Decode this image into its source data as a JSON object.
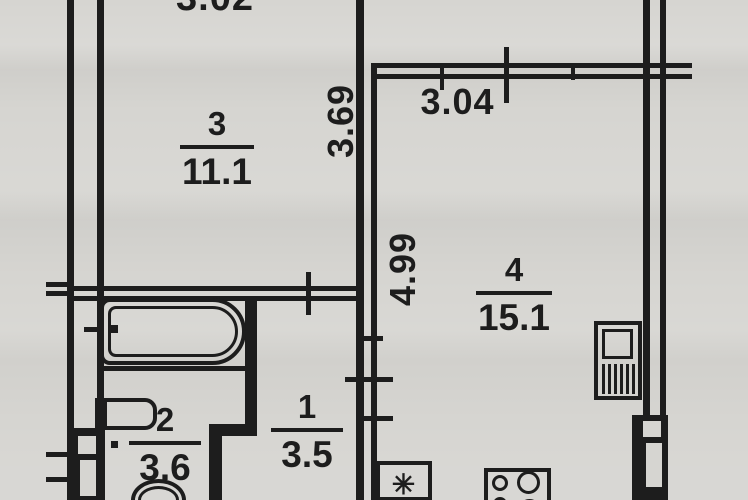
{
  "rooms": [
    {
      "number": "3",
      "area": "11.1"
    },
    {
      "number": "4",
      "area": "15.1"
    },
    {
      "number": "2",
      "area": "3.6"
    },
    {
      "number": "1",
      "area": "3.5"
    }
  ],
  "dimensions": {
    "top_width_partial": "3.02",
    "room3_depth": "3.69",
    "kitchen_width": "3.04",
    "kitchen_depth": "4.99"
  },
  "fixtures": {
    "sink_symbol": "✳"
  },
  "colors": {
    "paper": "#d6d5d1",
    "ink": "#1d1d1d"
  }
}
